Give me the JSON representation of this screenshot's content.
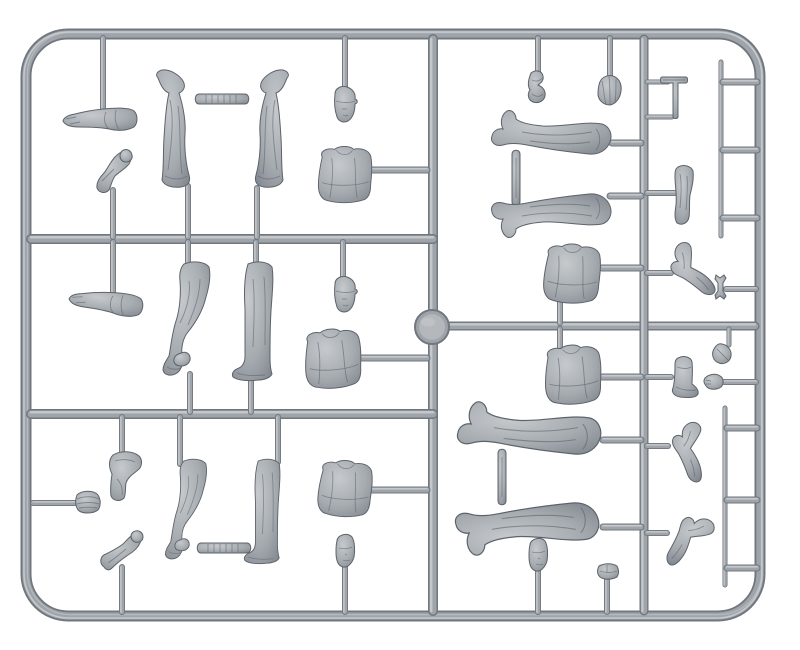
{
  "meta": {
    "description": "Photograph of an injection-moulded grey plastic model-kit sprue holding figure parts",
    "subject": "model figure sprue with legs, torsos, heads, arms, hands, caps and small tools"
  },
  "canvas": {
    "width": 800,
    "height": 650
  },
  "colors": {
    "background": "#ffffff",
    "plastic_light": "#c9cccf",
    "plastic_mid": "#9ea4aa",
    "plastic_dark": "#71777e",
    "plastic_stroke": "#5d636b",
    "part_light": "#c6cacd",
    "part_mid": "#a6abb0",
    "part_dark": "#7d838b",
    "hub_fill": "#b4b8bc"
  },
  "sprue": {
    "frame": {
      "x": 26,
      "y": 34,
      "width": 734,
      "height": 582,
      "radius": 42,
      "thickness": 11
    },
    "hub": {
      "cx": 432,
      "cy": 327,
      "r": 17
    },
    "runners": [
      {
        "x1": 433,
        "y1": 39,
        "x2": 433,
        "y2": 611,
        "w": 10
      },
      {
        "x1": 31,
        "y1": 239,
        "x2": 433,
        "y2": 239,
        "w": 10
      },
      {
        "x1": 31,
        "y1": 414,
        "x2": 433,
        "y2": 414,
        "w": 10
      },
      {
        "x1": 446,
        "y1": 326,
        "x2": 755,
        "y2": 326,
        "w": 9
      },
      {
        "x1": 644,
        "y1": 39,
        "x2": 644,
        "y2": 611,
        "w": 9
      },
      {
        "x1": 721,
        "y1": 62,
        "x2": 721,
        "y2": 236,
        "w": 5
      },
      {
        "x1": 725,
        "y1": 408,
        "x2": 725,
        "y2": 585,
        "w": 5
      }
    ],
    "gates": [
      [
        103,
        38,
        103,
        110,
        6
      ],
      [
        345,
        38,
        345,
        88,
        6
      ],
      [
        538,
        38,
        538,
        74,
        6
      ],
      [
        610,
        38,
        610,
        82,
        6
      ],
      [
        113,
        190,
        113,
        237,
        6
      ],
      [
        188,
        186,
        188,
        237,
        6
      ],
      [
        257,
        188,
        257,
        237,
        6
      ],
      [
        372,
        170,
        427,
        170,
        7
      ],
      [
        113,
        242,
        113,
        294,
        6
      ],
      [
        188,
        242,
        188,
        264,
        6
      ],
      [
        256,
        242,
        256,
        264,
        6
      ],
      [
        343,
        242,
        343,
        284,
        6
      ],
      [
        190,
        374,
        190,
        412,
        6
      ],
      [
        251,
        379,
        251,
        412,
        6
      ],
      [
        362,
        358,
        427,
        358,
        7
      ],
      [
        122,
        417,
        122,
        456,
        6
      ],
      [
        33,
        503,
        75,
        503,
        6
      ],
      [
        180,
        417,
        180,
        464,
        6
      ],
      [
        278,
        417,
        278,
        462,
        6
      ],
      [
        122,
        567,
        122,
        612,
        6
      ],
      [
        345,
        567,
        345,
        612,
        6
      ],
      [
        370,
        490,
        427,
        490,
        7
      ],
      [
        612,
        143,
        641,
        143,
        7
      ],
      [
        610,
        196,
        641,
        196,
        7
      ],
      [
        647,
        82,
        668,
        82,
        5
      ],
      [
        647,
        117,
        672,
        117,
        5
      ],
      [
        647,
        193,
        675,
        193,
        6
      ],
      [
        602,
        268,
        641,
        268,
        7
      ],
      [
        647,
        273,
        671,
        273,
        6
      ],
      [
        726,
        289,
        756,
        289,
        6
      ],
      [
        560,
        300,
        560,
        323,
        6
      ],
      [
        729,
        329,
        729,
        345,
        5
      ],
      [
        560,
        329,
        560,
        351,
        6
      ],
      [
        602,
        377,
        641,
        377,
        7
      ],
      [
        647,
        377,
        671,
        377,
        6
      ],
      [
        724,
        382,
        756,
        382,
        6
      ],
      [
        603,
        440,
        641,
        440,
        7
      ],
      [
        647,
        446,
        668,
        446,
        6
      ],
      [
        647,
        533,
        667,
        533,
        6
      ],
      [
        603,
        527,
        641,
        527,
        7
      ],
      [
        538,
        571,
        538,
        612,
        6
      ],
      [
        607,
        579,
        607,
        612,
        6
      ],
      [
        723,
        82,
        757,
        82,
        7
      ],
      [
        723,
        150,
        757,
        150,
        7
      ],
      [
        723,
        218,
        757,
        218,
        7
      ],
      [
        727,
        428,
        757,
        428,
        7
      ],
      [
        727,
        500,
        757,
        500,
        7
      ],
      [
        727,
        568,
        757,
        568,
        7
      ]
    ]
  },
  "parts": [
    {
      "name": "open-hand-arm",
      "type": "arm_hand",
      "x": 100,
      "y": 119
    },
    {
      "name": "gripping-bent-arm",
      "type": "arm_grip",
      "x": 112,
      "y": 173
    },
    {
      "name": "greatcoat-legs-left",
      "type": "legs_coat",
      "x": 177,
      "y": 130
    },
    {
      "name": "greatcoat-legs-right",
      "type": "legs_coat",
      "x": 268,
      "y": 130,
      "sx": -1
    },
    {
      "name": "ribbed-tie-bar-top",
      "type": "bar_ribbed",
      "x": 222,
      "y": 99
    },
    {
      "name": "capped-head-upper",
      "type": "head_cap",
      "x": 344,
      "y": 107
    },
    {
      "name": "jacket-torso-upper-left",
      "type": "torso",
      "x": 345,
      "y": 175,
      "s": 0.95
    },
    {
      "name": "straight-arm",
      "type": "arm_hand",
      "x": 106,
      "y": 302,
      "rot": 8
    },
    {
      "name": "bent-knee-legs-middle",
      "type": "legs_bent",
      "x": 191,
      "y": 323
    },
    {
      "name": "standing-legs-middle",
      "type": "legs_straight",
      "x": 257,
      "y": 323
    },
    {
      "name": "capped-head-middle",
      "type": "head_cap",
      "x": 344,
      "y": 297
    },
    {
      "name": "jacket-torso-middle-left",
      "type": "torso",
      "x": 333,
      "y": 359,
      "rot": -4
    },
    {
      "name": "hanging-bent-arm",
      "type": "arm_down",
      "x": 125,
      "y": 477
    },
    {
      "name": "rolled-side-cap",
      "type": "cap_pill",
      "x": 88,
      "y": 502
    },
    {
      "name": "bent-knee-legs-lower",
      "type": "legs_bent",
      "x": 190,
      "y": 513,
      "s": 0.88
    },
    {
      "name": "standing-legs-lower",
      "type": "legs_straight",
      "x": 266,
      "y": 513,
      "s": 0.88
    },
    {
      "name": "ribbed-tie-bar-bottom",
      "type": "bar_ribbed",
      "x": 224,
      "y": 548
    },
    {
      "name": "raised-fist-arm",
      "type": "arm_fist",
      "x": 120,
      "y": 551
    },
    {
      "name": "jacket-torso-lower-left",
      "type": "torso",
      "x": 345,
      "y": 489,
      "rot": 3,
      "s": 0.95
    },
    {
      "name": "bare-head-lower-left",
      "type": "head_bare",
      "x": 345,
      "y": 552
    },
    {
      "name": "twisted-side-cap",
      "type": "cap_side",
      "x": 538,
      "y": 88
    },
    {
      "name": "ribbed-capped-head",
      "type": "head_ribbed",
      "x": 609,
      "y": 92
    },
    {
      "name": "hammer-tool",
      "type": "hammer",
      "x": 676,
      "y": 97
    },
    {
      "name": "lying-legs-toe-up-upper",
      "type": "legs_horiz",
      "x": 552,
      "y": 139
    },
    {
      "name": "tie-bar-upper-right",
      "type": "bar_plain",
      "x": 516,
      "y": 178
    },
    {
      "name": "lying-legs-toe-down-upper",
      "type": "legs_horiz",
      "x": 552,
      "y": 209,
      "sy": -1
    },
    {
      "name": "hanging-arm",
      "type": "arm_hang",
      "x": 684,
      "y": 196
    },
    {
      "name": "jacket-torso-upper-right",
      "type": "torso",
      "x": 572,
      "y": 274,
      "rot": 2
    },
    {
      "name": "bent-elbow-arm",
      "type": "arm_elbow",
      "x": 690,
      "y": 271,
      "rot": -20
    },
    {
      "name": "wrench-tool",
      "type": "wrench",
      "x": 721,
      "y": 287
    },
    {
      "name": "jacket-torso-lower-right",
      "type": "torso",
      "x": 573,
      "y": 375,
      "rot": -3
    },
    {
      "name": "single-boot",
      "type": "boot",
      "x": 684,
      "y": 377
    },
    {
      "name": "oval-pouch",
      "type": "leaf",
      "x": 722,
      "y": 354
    },
    {
      "name": "small-hand",
      "type": "hand_small",
      "x": 714,
      "y": 382
    },
    {
      "name": "lying-legs-toe-up-lower",
      "type": "legs_horiz",
      "x": 530,
      "y": 436,
      "s": 1.2
    },
    {
      "name": "gauntlet-elbow-arm-upper",
      "type": "arm_elbow",
      "x": 688,
      "y": 451,
      "rot": 10
    },
    {
      "name": "tie-bar-lower-right",
      "type": "bar_plain",
      "x": 502,
      "y": 477
    },
    {
      "name": "lying-legs-toe-down-lower",
      "type": "legs_horiz",
      "x": 528,
      "y": 521,
      "s": 1.2,
      "sy": -1
    },
    {
      "name": "gauntlet-elbow-arm-lower",
      "type": "arm_elbow",
      "x": 687,
      "y": 537,
      "rot": 60
    },
    {
      "name": "bare-head-lower-right",
      "type": "head_bare",
      "x": 538,
      "y": 556
    },
    {
      "name": "goggles-visor",
      "type": "goggles",
      "x": 608,
      "y": 572
    }
  ]
}
